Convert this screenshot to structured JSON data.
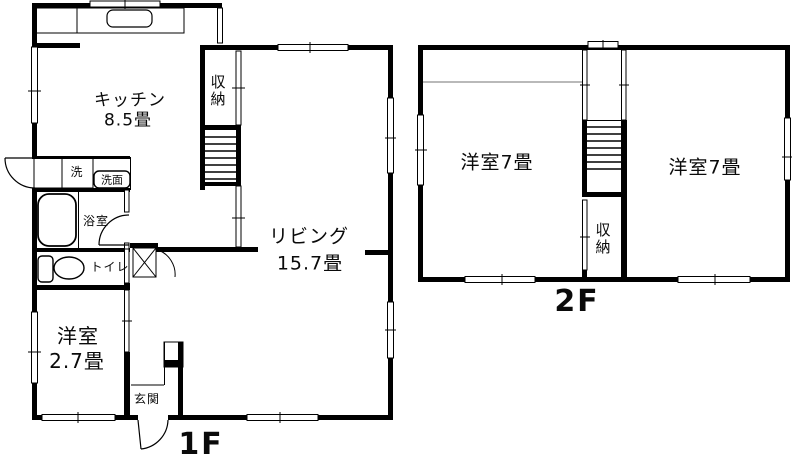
{
  "floor1": {
    "label": "1F",
    "kitchen_name": "キッチン",
    "kitchen_size": "8.5畳",
    "storage": "収納",
    "living_name": "リビング",
    "living_size": "15.7畳",
    "washer": "洗",
    "washroom": "洗面",
    "bathroom": "浴室",
    "toilet": "トイレ",
    "western_name": "洋室",
    "western_size": "2.7畳",
    "entrance": "玄関"
  },
  "floor2": {
    "label": "2F",
    "room_left": "洋室7畳",
    "room_right": "洋室7畳",
    "storage": "収納"
  },
  "colors": {
    "line": "#000000",
    "bg": "#ffffff"
  }
}
